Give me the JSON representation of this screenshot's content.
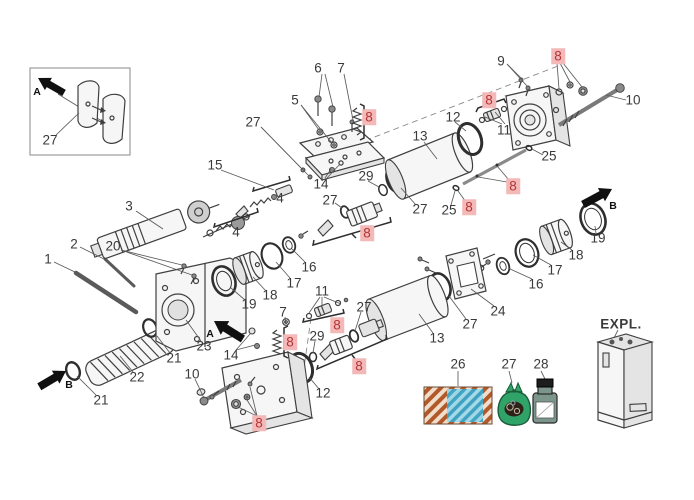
{
  "meta": {
    "background": "#ffffff",
    "line_color": "#3f3f3f",
    "label_color": "#3a3a3a",
    "highlight_bg": "#f3b8b8",
    "highlight_fg": "#b53434",
    "legend_orange": "#b2592a",
    "legend_blue": "#3aa5c8",
    "legend_green": "#2fa368",
    "legend_bottle": "#7d968b"
  },
  "expl": {
    "label": "EXPL."
  },
  "legend": {
    "items": [
      {
        "callout": "26",
        "name": "abrasive-backing-sheet"
      },
      {
        "callout": "27",
        "name": "seal-kit-bag"
      },
      {
        "callout": "28",
        "name": "oil-bottle"
      }
    ]
  },
  "view_arrows": [
    {
      "label": "A",
      "x": 37,
      "y": 92
    },
    {
      "label": "A",
      "x": 210,
      "y": 334
    },
    {
      "label": "B",
      "x": 613,
      "y": 206
    },
    {
      "label": "B",
      "x": 69,
      "y": 385
    }
  ],
  "callouts": [
    {
      "t": "27",
      "x": 50,
      "y": 140,
      "hl": false
    },
    {
      "t": "6",
      "x": 318,
      "y": 68,
      "hl": false
    },
    {
      "t": "7",
      "x": 341,
      "y": 68,
      "hl": false
    },
    {
      "t": "5",
      "x": 295,
      "y": 100,
      "hl": false
    },
    {
      "t": "8",
      "x": 369,
      "y": 117,
      "hl": true
    },
    {
      "t": "27",
      "x": 253,
      "y": 122,
      "hl": false
    },
    {
      "t": "9",
      "x": 501,
      "y": 61,
      "hl": false
    },
    {
      "t": "8",
      "x": 558,
      "y": 56,
      "hl": true
    },
    {
      "t": "10",
      "x": 633,
      "y": 100,
      "hl": false
    },
    {
      "t": "8",
      "x": 489,
      "y": 100,
      "hl": true
    },
    {
      "t": "11",
      "x": 504,
      "y": 130,
      "hl": false
    },
    {
      "t": "12",
      "x": 453,
      "y": 117,
      "hl": false
    },
    {
      "t": "13",
      "x": 420,
      "y": 136,
      "hl": false
    },
    {
      "t": "25",
      "x": 549,
      "y": 156,
      "hl": false
    },
    {
      "t": "8",
      "x": 513,
      "y": 186,
      "hl": true
    },
    {
      "t": "25",
      "x": 449,
      "y": 210,
      "hl": false
    },
    {
      "t": "8",
      "x": 469,
      "y": 207,
      "hl": true
    },
    {
      "t": "29",
      "x": 366,
      "y": 176,
      "hl": false
    },
    {
      "t": "14",
      "x": 321,
      "y": 184,
      "hl": false
    },
    {
      "t": "27",
      "x": 330,
      "y": 200,
      "hl": false
    },
    {
      "t": "27",
      "x": 420,
      "y": 209,
      "hl": false
    },
    {
      "t": "8",
      "x": 367,
      "y": 233,
      "hl": true
    },
    {
      "t": "15",
      "x": 215,
      "y": 165,
      "hl": false
    },
    {
      "t": "4",
      "x": 280,
      "y": 198,
      "hl": false
    },
    {
      "t": "4",
      "x": 236,
      "y": 232,
      "hl": false
    },
    {
      "t": "3",
      "x": 129,
      "y": 206,
      "hl": false
    },
    {
      "t": "2",
      "x": 74,
      "y": 244,
      "hl": false
    },
    {
      "t": "20",
      "x": 113,
      "y": 246,
      "hl": false
    },
    {
      "t": "1",
      "x": 48,
      "y": 259,
      "hl": false
    },
    {
      "t": "16",
      "x": 309,
      "y": 267,
      "hl": false
    },
    {
      "t": "17",
      "x": 294,
      "y": 283,
      "hl": false
    },
    {
      "t": "18",
      "x": 270,
      "y": 295,
      "hl": false
    },
    {
      "t": "19",
      "x": 249,
      "y": 304,
      "hl": false
    },
    {
      "t": "23",
      "x": 204,
      "y": 346,
      "hl": false
    },
    {
      "t": "21",
      "x": 174,
      "y": 358,
      "hl": false
    },
    {
      "t": "22",
      "x": 137,
      "y": 377,
      "hl": false
    },
    {
      "t": "21",
      "x": 101,
      "y": 400,
      "hl": false
    },
    {
      "t": "14",
      "x": 231,
      "y": 355,
      "hl": false
    },
    {
      "t": "10",
      "x": 192,
      "y": 374,
      "hl": false
    },
    {
      "t": "7",
      "x": 283,
      "y": 312,
      "hl": false
    },
    {
      "t": "8",
      "x": 290,
      "y": 342,
      "hl": true
    },
    {
      "t": "11",
      "x": 322,
      "y": 291,
      "hl": false
    },
    {
      "t": "8",
      "x": 337,
      "y": 325,
      "hl": true
    },
    {
      "t": "29",
      "x": 317,
      "y": 336,
      "hl": false
    },
    {
      "t": "27",
      "x": 364,
      "y": 307,
      "hl": false
    },
    {
      "t": "8",
      "x": 359,
      "y": 366,
      "hl": true
    },
    {
      "t": "12",
      "x": 323,
      "y": 393,
      "hl": false
    },
    {
      "t": "13",
      "x": 437,
      "y": 338,
      "hl": false
    },
    {
      "t": "8",
      "x": 259,
      "y": 423,
      "hl": true
    },
    {
      "t": "19",
      "x": 598,
      "y": 238,
      "hl": false
    },
    {
      "t": "18",
      "x": 576,
      "y": 255,
      "hl": false
    },
    {
      "t": "17",
      "x": 555,
      "y": 270,
      "hl": false
    },
    {
      "t": "16",
      "x": 536,
      "y": 284,
      "hl": false
    },
    {
      "t": "24",
      "x": 498,
      "y": 311,
      "hl": false
    },
    {
      "t": "27",
      "x": 470,
      "y": 324,
      "hl": false
    },
    {
      "t": "26",
      "x": 458,
      "y": 364,
      "hl": false
    },
    {
      "t": "27",
      "x": 509,
      "y": 364,
      "hl": false
    },
    {
      "t": "28",
      "x": 541,
      "y": 364,
      "hl": false
    }
  ]
}
